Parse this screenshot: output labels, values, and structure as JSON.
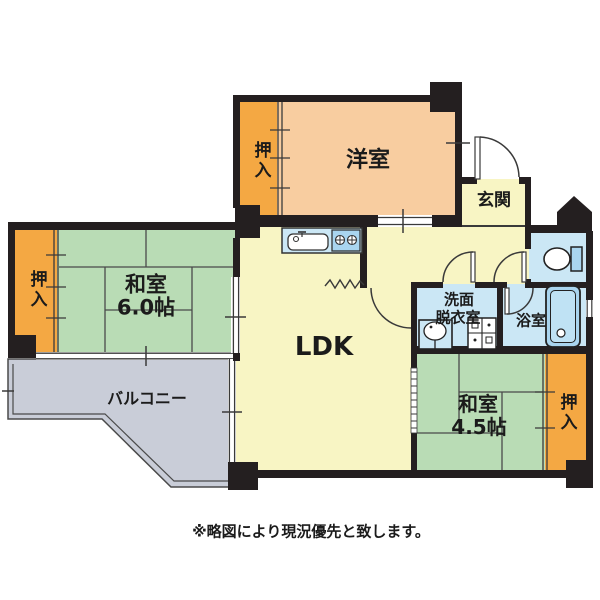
{
  "floor_plan": {
    "rooms": {
      "western_room": {
        "label": "洋室"
      },
      "entrance": {
        "label": "玄関"
      },
      "japanese_room_6": {
        "label": "和室",
        "size": "6.0帖"
      },
      "japanese_room_45": {
        "label": "和室",
        "size": "4.5帖"
      },
      "ldk": {
        "label": "LDK"
      },
      "washroom": {
        "label_line1": "洗面",
        "label_line2": "脱衣室"
      },
      "bathroom": {
        "label": "浴室"
      },
      "balcony": {
        "label": "バルコニー"
      },
      "closet": {
        "label": "押入"
      }
    },
    "note": "※略図により現況優先と致します。",
    "colors": {
      "wall": "#241f20",
      "tatami_green": "#b9dcb5",
      "ldk_yellow": "#f8f5c4",
      "western_peach": "#f8cda0",
      "closet_orange": "#f4a843",
      "wet_blue": "#cbe7f5",
      "balcony_gray": "#c9cdd8",
      "fixture_blue": "#a9d5ef",
      "line": "#3a3a3a"
    }
  }
}
